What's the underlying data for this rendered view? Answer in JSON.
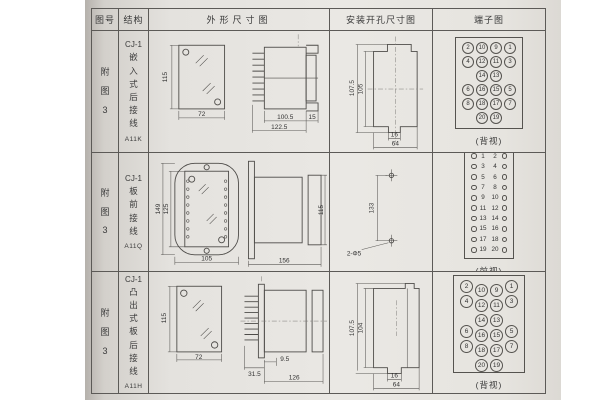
{
  "table": {
    "headers": {
      "fig": "图号",
      "structure": "结构",
      "outline": "外形尺寸图",
      "mounting": "安装开孔尺寸图",
      "terminal": "端子图"
    },
    "rows": [
      {
        "fig": "附图3",
        "model": "CJ-1",
        "structure": "嵌入式后接线",
        "code": "A11K",
        "outline": {
          "front_h": "115",
          "front_w": "72",
          "body_len": "100.5",
          "total_len": "122.5",
          "flange": "15"
        },
        "mounting": {
          "outer_h": "107.5",
          "inner_h": "105",
          "slot_w": "16",
          "cutout_w": "64"
        },
        "terminal": {
          "style": "grid",
          "view": "(背视)",
          "cells": [
            [
              "2",
              "10",
              "9",
              "1"
            ],
            [
              "4",
              "12",
              "11",
              "3"
            ],
            [
              "",
              "14",
              "13",
              ""
            ],
            [
              "6",
              "16",
              "15",
              "5"
            ],
            [
              "8",
              "18",
              "17",
              "7"
            ],
            [
              "",
              "20",
              "19",
              ""
            ]
          ]
        }
      },
      {
        "fig": "附图3",
        "model": "CJ-1",
        "structure": "板前接线",
        "code": "A11Q",
        "outline": {
          "front_h": "149",
          "inner_h": "125",
          "front_w": "105",
          "side_len": "156",
          "side_h": "115"
        },
        "mounting": {
          "hole_dist": "133",
          "holes": "2-Φ5"
        },
        "terminal": {
          "style": "strip",
          "view": "(前视)",
          "cells": [
            [
              "1",
              "2"
            ],
            [
              "3",
              "4"
            ],
            [
              "5",
              "6"
            ],
            [
              "7",
              "8"
            ],
            [
              "9",
              "10"
            ],
            [
              "11",
              "12"
            ],
            [
              "13",
              "14"
            ],
            [
              "15",
              "16"
            ],
            [
              "17",
              "18"
            ],
            [
              "19",
              "20"
            ]
          ]
        }
      },
      {
        "fig": "附图3",
        "model": "CJ-1",
        "structure": "凸出式板后接线",
        "code": "A11H",
        "outline": {
          "front_h": "115",
          "front_w": "72",
          "pin_len": "31.5",
          "step": "9.5",
          "body_len": "126"
        },
        "mounting": {
          "outer_h": "107.5",
          "inner_h": "104",
          "slot_w": "16",
          "cutout_w": "64"
        },
        "terminal": {
          "style": "staggered",
          "view": "(背视)",
          "cells": [
            [
              "2",
              "10",
              "9",
              "1"
            ],
            [
              "4",
              "12",
              "11",
              "3"
            ],
            [
              "",
              "14",
              "13",
              ""
            ],
            [
              "6",
              "16",
              "15",
              "5"
            ],
            [
              "8",
              "18",
              "17",
              "7"
            ],
            [
              "",
              "20",
              "19",
              ""
            ]
          ]
        }
      }
    ]
  }
}
